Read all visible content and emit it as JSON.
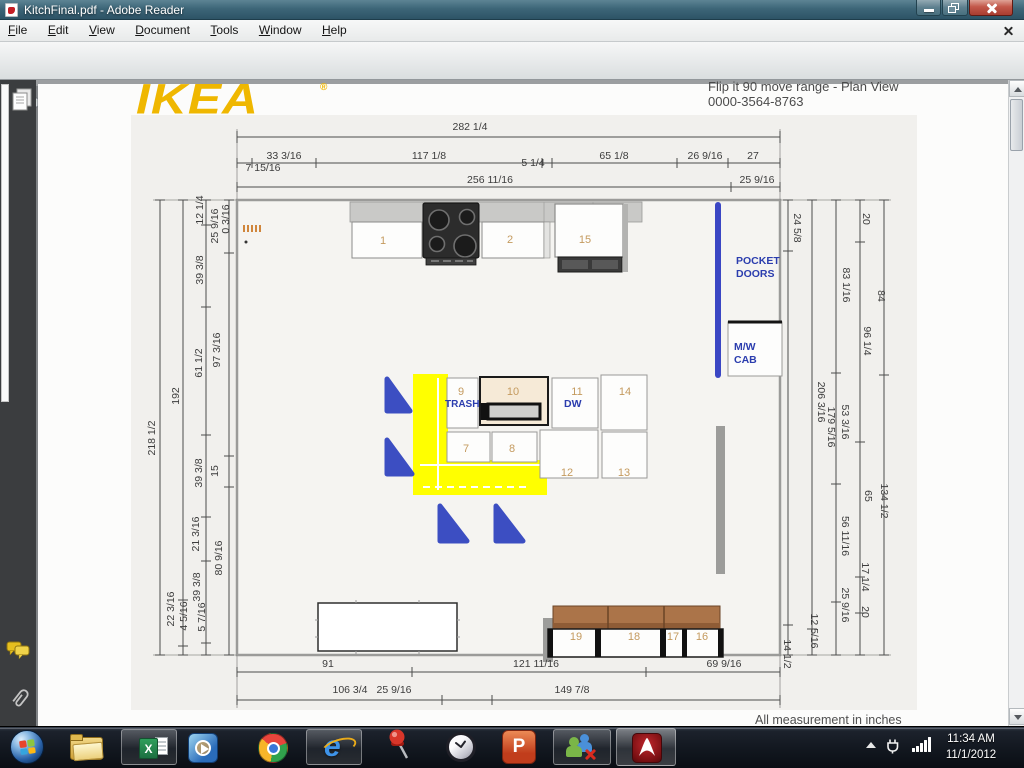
{
  "titlebar": {
    "title": "KitchFinal.pdf - Adobe Reader"
  },
  "menu": {
    "items": [
      "File",
      "Edit",
      "View",
      "Document",
      "Tools",
      "Window",
      "Help"
    ]
  },
  "toolbar": {
    "page_current": "6",
    "page_total": "/ 10",
    "zoom_value": "102%",
    "find_placeholder": "Find"
  },
  "pdf": {
    "logo": "IKEA",
    "logo_reg": "®",
    "header_line1": "Flip it 90 move range - Plan View",
    "header_line2": "0000-3564-8763",
    "footer": "All measurement in inches",
    "labels": {
      "trash": "TRASH",
      "dw": "DW",
      "pocket_doors": "POCKET DOORS",
      "mw_cab": "M/W CAB"
    },
    "cabinets": {
      "n1": "1",
      "n2": "2",
      "n15": "15",
      "n9": "9",
      "n10": "10",
      "n11": "11",
      "n14": "14",
      "n7": "7",
      "n8": "8",
      "n12": "12",
      "n13": "13",
      "n19": "19",
      "n18": "18",
      "n17": "17",
      "n16": "16"
    },
    "dims": {
      "top": [
        "282 1/4",
        "33 3/16",
        "117 1/8",
        "5 1/4",
        "65 1/8",
        "26 9/16",
        "27",
        "7 15/16",
        "256 11/16",
        "25 9/16"
      ],
      "left": [
        "218 1/2",
        "192",
        "22 3/16",
        "4 5/16",
        "12 1/4",
        "39 3/8",
        "61 1/2",
        "39 3/8",
        "21 3/16",
        "39 3/8",
        "5 7/16",
        "25 9/16",
        "0 3/16",
        "97 3/16",
        "15",
        "80 9/16"
      ],
      "right": [
        "24 5/8",
        "179 5/16",
        "14 1/2",
        "206 3/16",
        "12 5/16",
        "83 1/16",
        "53 3/16",
        "56 11/16",
        "25 9/16",
        "20",
        "96 1/4",
        "65",
        "17 1/4",
        "20",
        "84",
        "134 1/2"
      ],
      "bottom": [
        "91",
        "121 11/16",
        "69 9/16",
        "106 3/4",
        "25 9/16",
        "149 7/8"
      ]
    }
  },
  "taskbar": {
    "excel_letter": "X",
    "ie_letter": "e",
    "ppt_letter": "P",
    "time": "11:34 AM",
    "date": "11/1/2012"
  }
}
